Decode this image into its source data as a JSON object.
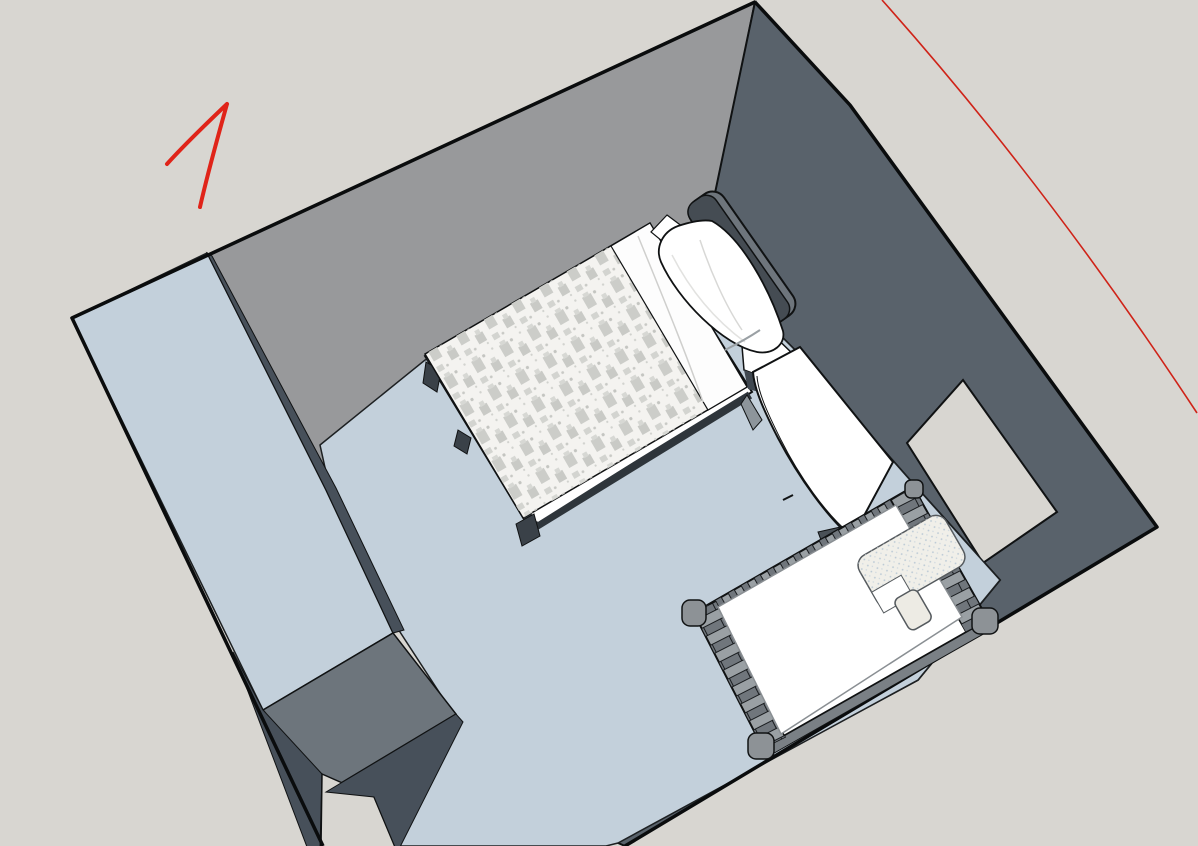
{
  "app": {
    "name": "3d-room-model-viewport",
    "content": "isometric 3D model of a nursery bedroom viewed from above with red hand-drawn annotations"
  },
  "scene": {
    "background_color": "#d8d6d1",
    "edge_color": "#101213",
    "room": {
      "floor_color": "#c3d0db",
      "back_left_wall_color": "#98999b",
      "back_right_wall_color": "#59626b",
      "front_wall_top_color": "#47505a",
      "door_wall_inner_color": "#6d757c",
      "window_color": "#d8d6d1"
    },
    "bed": {
      "name": "single bed",
      "headboard_color": "#454c53",
      "headboard_edge_color": "#6e757c",
      "frame_color": "#ffffff",
      "frame_shadow_color": "#2e353b",
      "duvet_color": "#f4f3f0",
      "duvet_pattern_color": "#c9cac6",
      "sheet_color": "#fdfdfd",
      "pillow_color": "#ffffff",
      "leg_color": "#3a4148"
    },
    "desk": {
      "name": "desk",
      "top_color": "#ffffff",
      "side_color": "#8d959b",
      "shadow_color": "#4a5157"
    },
    "crib": {
      "name": "crib",
      "frame_color": "#ffffff",
      "rail_color": "#9aa0a4",
      "slat_color": "#70767c",
      "outer_face_color": "#7a8085",
      "post_color": "#8d9296",
      "mattress_color": "#ffffff",
      "blanket_color": "#f0efe9",
      "blanket_flap_color": "#edebe4"
    },
    "annotations": {
      "stroke_mark": {
        "color": "#e02419",
        "shape": "hand-drawn numeral-1 / arrow stroke, upper left"
      },
      "diagonal_line": {
        "color": "#cf2318",
        "shape": "thin freehand diagonal line across top-right corner"
      }
    }
  }
}
